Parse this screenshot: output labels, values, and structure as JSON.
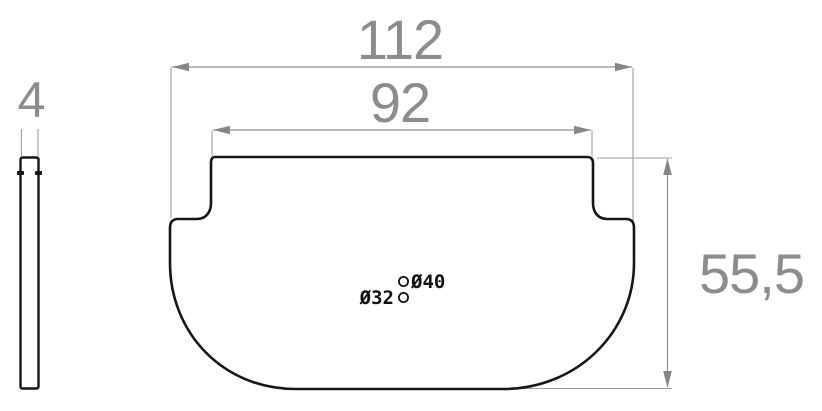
{
  "dimensions": {
    "overall_width": {
      "value": "112"
    },
    "top_width": {
      "value": "92"
    },
    "thickness": {
      "value": "4"
    },
    "height": {
      "value": "55,5"
    }
  },
  "holes": [
    {
      "label": "Ø40"
    },
    {
      "label": "Ø32"
    }
  ],
  "colors": {
    "outline": "#161616",
    "dimension_text": "#8c8c8c",
    "dimension_line": "#8f8f8f",
    "extension_line": "#9e9e9e"
  }
}
